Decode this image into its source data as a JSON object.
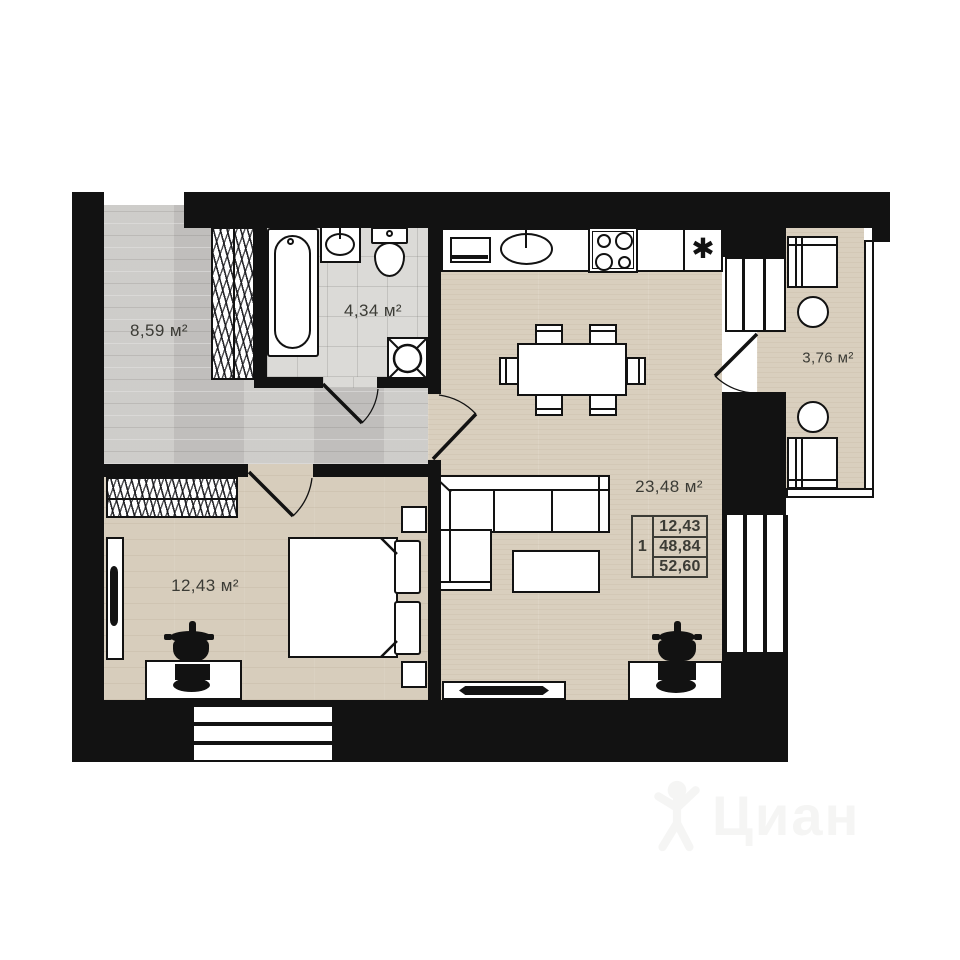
{
  "plan": {
    "rooms": {
      "hallway": {
        "area_label": "8,59 м²"
      },
      "bathroom": {
        "area_label": "4,34 м²"
      },
      "bedroom": {
        "area_label": "12,43 м²"
      },
      "living_kitchen": {
        "area_label": "23,48 м²"
      },
      "balcony": {
        "area_label": "3,76 м²"
      }
    },
    "info_table": {
      "unit_number": "1",
      "rows": [
        {
          "value": "12,43"
        },
        {
          "value": "48,84"
        },
        {
          "value": "52,60"
        }
      ]
    },
    "symbols": {
      "fridge_asterisk": "✱"
    },
    "colors": {
      "wall": "#121212",
      "text": "#3b3b35",
      "floor_wood": "#d9cfbe",
      "floor_gray": "#c9c7c4",
      "floor_tile": "#dbdad7",
      "watermark": "#f5f5f4"
    }
  },
  "watermark": {
    "text": "Циан"
  }
}
